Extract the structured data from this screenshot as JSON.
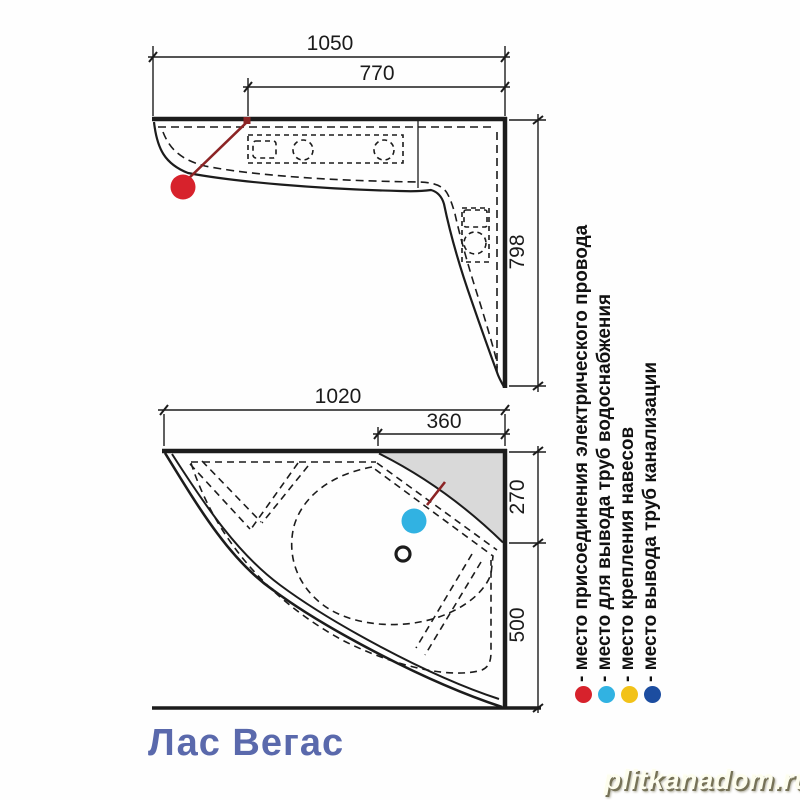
{
  "page": {
    "title": "Лас Вегас",
    "watermark": "plitkanadom.ru"
  },
  "top_view": {
    "dims": {
      "total_width": "1050",
      "deck_width": "770",
      "right_height": "798"
    }
  },
  "plan_view": {
    "dims": {
      "total_width": "1020",
      "shelf_width": "360",
      "shelf_depth": "270",
      "basin_depth": "500"
    }
  },
  "legend": {
    "items": [
      {
        "id": "electric",
        "color": "#d7222c",
        "label": "- место присоединения электрического провода"
      },
      {
        "id": "water-supply",
        "color": "#31b2e2",
        "label": "- место для вывода труб водоснабжения"
      },
      {
        "id": "hangers",
        "color": "#f2c219",
        "label": "- место крепления навесов"
      },
      {
        "id": "sewer",
        "color": "#1c4da0",
        "label": "- место вывода труб канализации"
      }
    ]
  },
  "colors": {
    "line": "#1c1c1c",
    "shelf_fill": "#d9d9d9",
    "marker_red": "#e02027",
    "marker_leader": "#8c2425",
    "title_blue": "#5a69ac"
  }
}
